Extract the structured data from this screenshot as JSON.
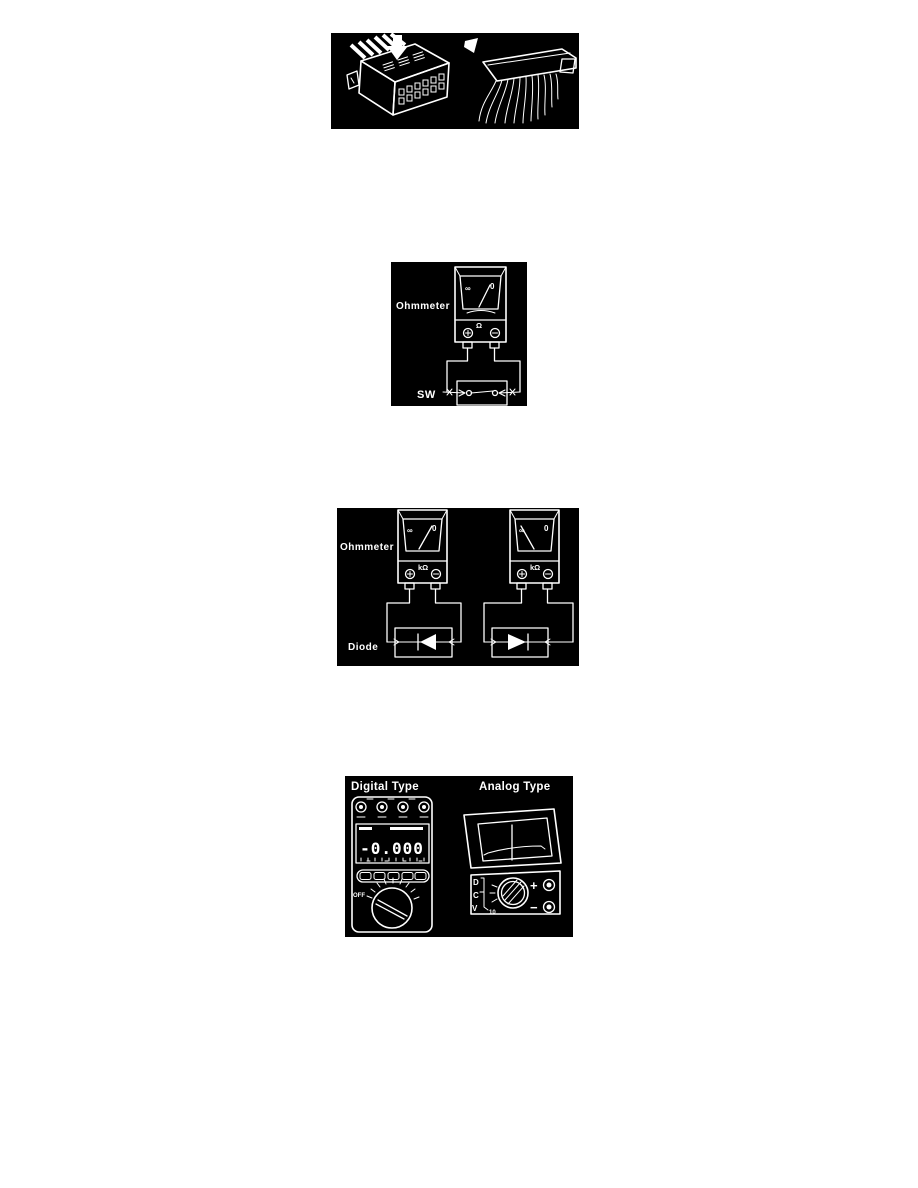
{
  "colors": {
    "page_background": "#ffffff",
    "figure_background": "#000000",
    "ink": "#ffffff"
  },
  "fig_ohmmeter_switch": {
    "ohmmeter_label": "Ohmmeter",
    "switch_label": "SW",
    "scale_left": "∞",
    "scale_right": "0",
    "unit": "Ω"
  },
  "fig_ohmmeter_diode": {
    "ohmmeter_label": "Ohmmeter",
    "diode_label": "Diode",
    "scale_left": "∞",
    "scale_right": "0",
    "unit": "kΩ"
  },
  "fig_meter_types": {
    "digital_title": "Digital Type",
    "analog_title": "Analog Type",
    "digital_display": "-0.000",
    "dial_off": "OFF",
    "analog_letters": [
      "D",
      "C",
      "V"
    ],
    "analog_range_value": "10",
    "plus": "+",
    "minus": "−"
  }
}
